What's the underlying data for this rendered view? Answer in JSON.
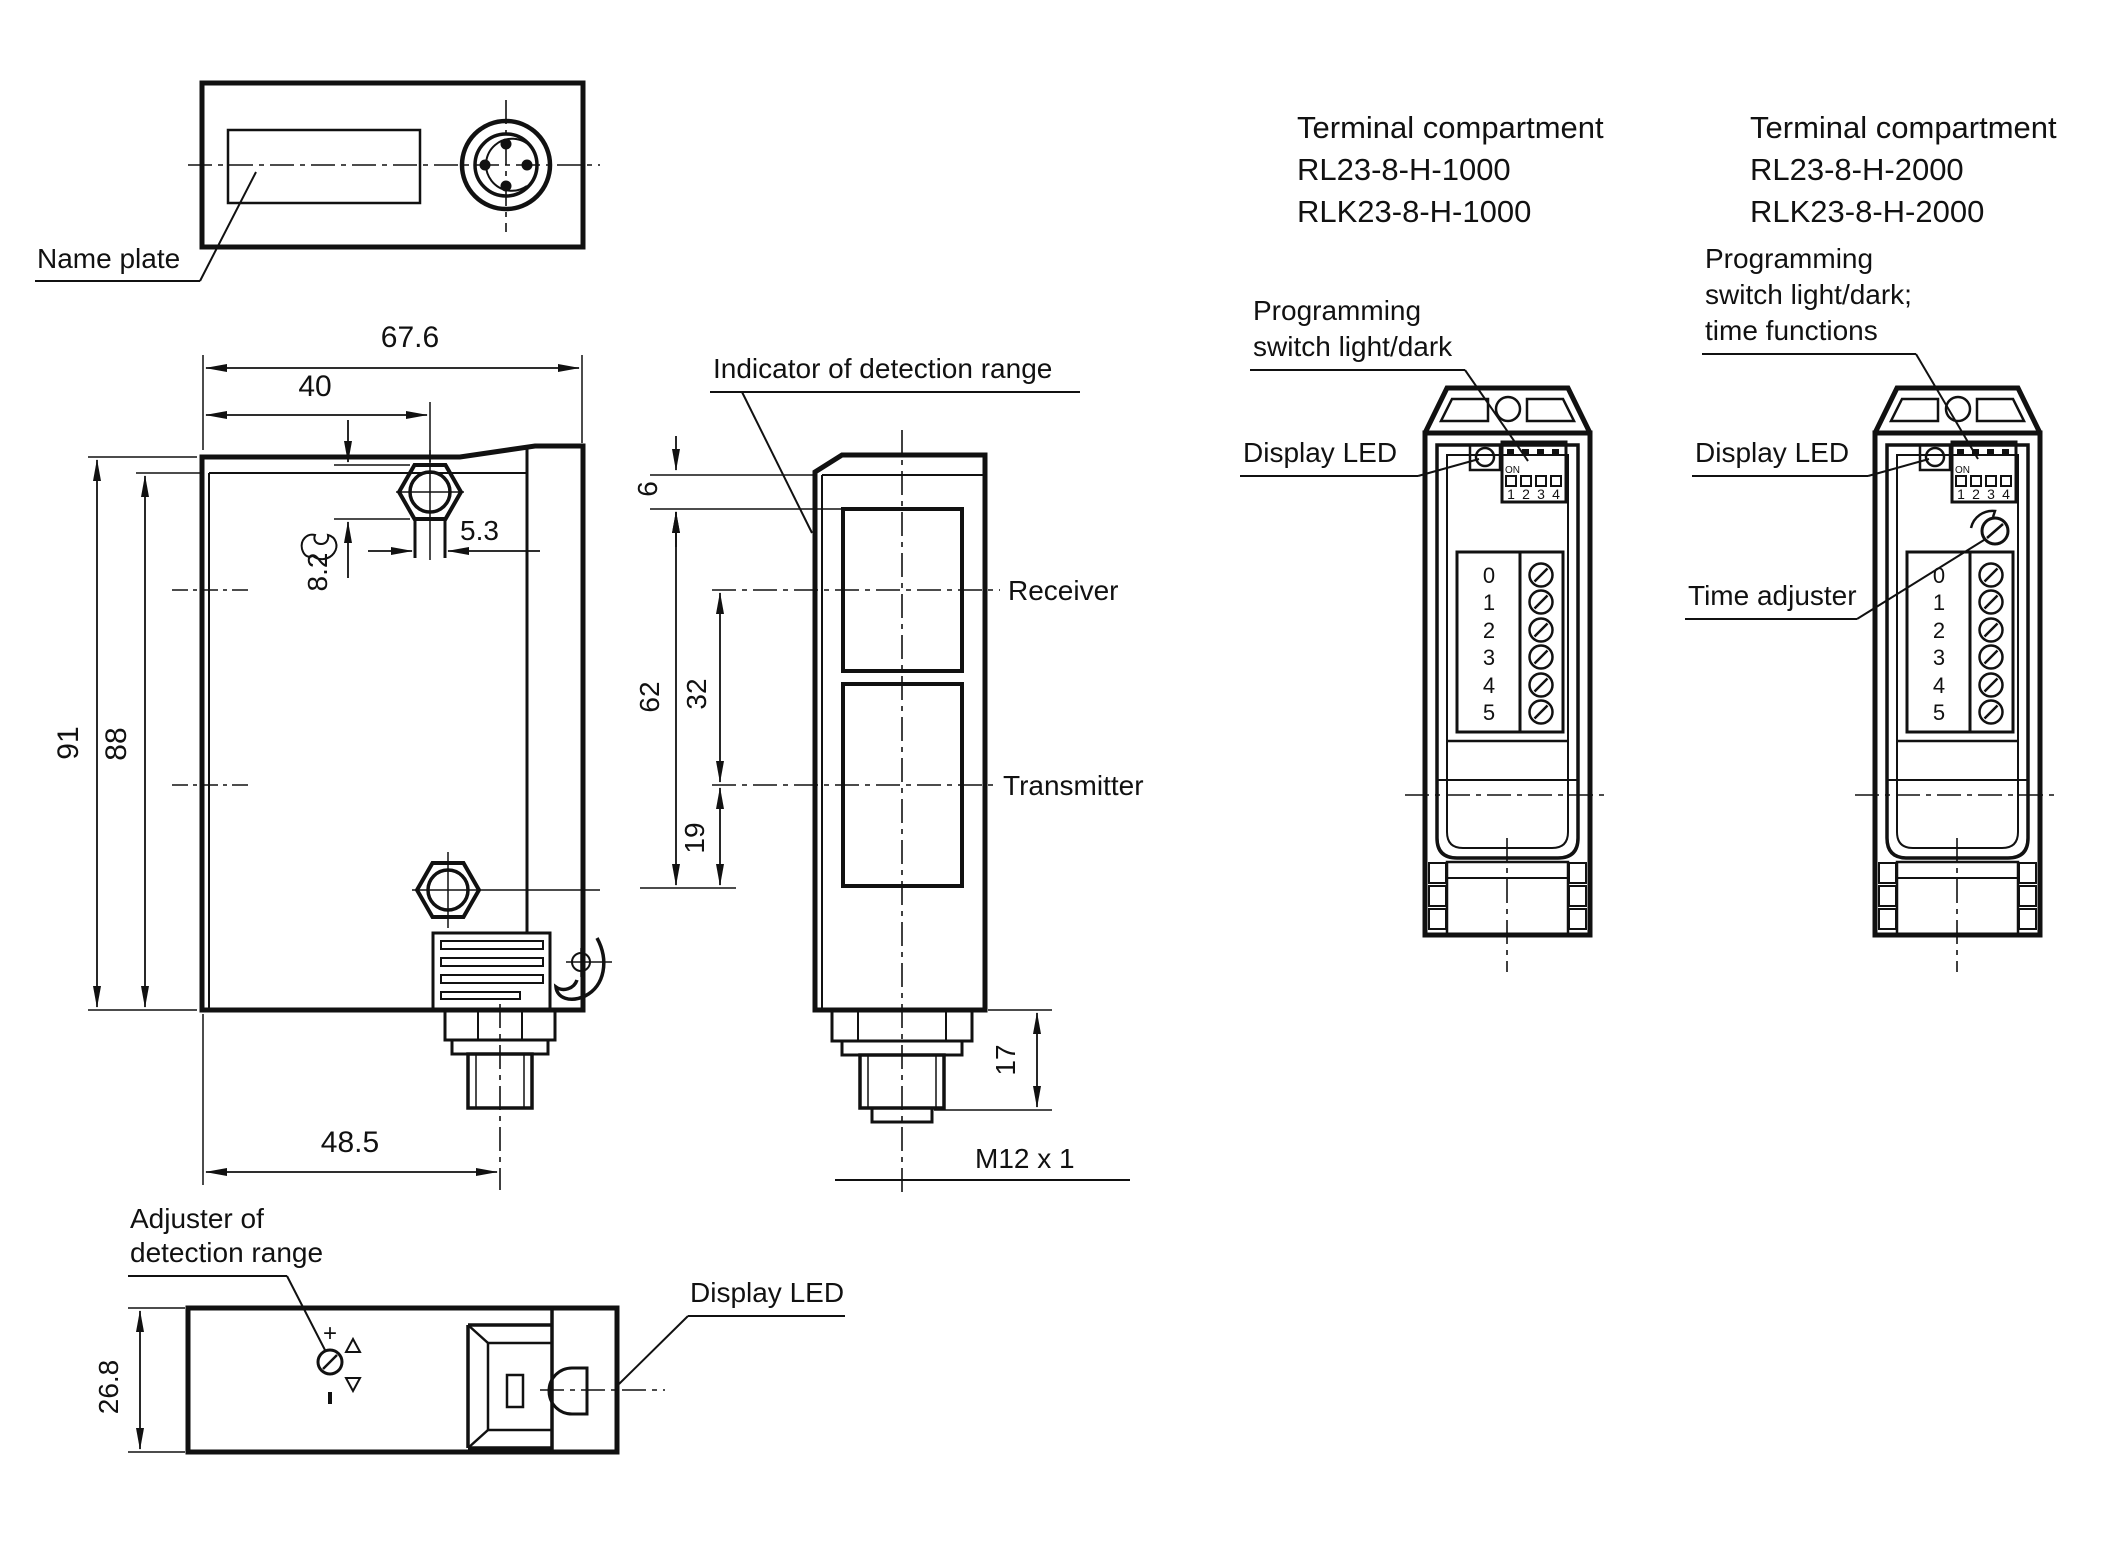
{
  "page": {
    "background": "#ffffff",
    "ink": "#111111"
  },
  "top_view": {
    "name_plate_label": "Name plate"
  },
  "front_view": {
    "dim_width": "67.6",
    "dim_hole_x": "40",
    "dim_height_outer": "91",
    "dim_height_inner": "88",
    "dim_nut_flats": "8.2",
    "dim_slot_width": "5.3",
    "dim_connector_x": "48.5"
  },
  "side_view": {
    "indicator_label": "Indicator of detection range",
    "receiver_label": "Receiver",
    "transmitter_label": "Transmitter",
    "dim_top_edge": "6",
    "dim_window": "62",
    "dim_axis_gap": "32",
    "dim_lower": "19",
    "dim_thread": "17",
    "thread_label": "M12 x 1"
  },
  "bottom_view": {
    "adjuster_label_line1": "Adjuster of",
    "adjuster_label_line2": "detection range",
    "display_led_label": "Display LED",
    "dim_depth": "26.8",
    "plus_mark": "+"
  },
  "terminal_shared": {
    "dip_on": "ON",
    "dip_digits": [
      "1",
      "2",
      "3",
      "4"
    ],
    "terminal_numbers": [
      "0",
      "1",
      "2",
      "3",
      "4",
      "5"
    ]
  },
  "terminal_1": {
    "title": "Terminal compartment",
    "model_a": "RL23-8-H-1000",
    "model_b": "RLK23-8-H-1000",
    "programming_line1": "Programming",
    "programming_line2": "switch light/dark",
    "display_led_label": "Display LED"
  },
  "terminal_2": {
    "title": "Terminal compartment",
    "model_a": "RL23-8-H-2000",
    "model_b": "RLK23-8-H-2000",
    "programming_line1": "Programming",
    "programming_line2": "switch light/dark;",
    "programming_line3": "time functions",
    "display_led_label": "Display LED",
    "time_adjuster_label": "Time adjuster"
  }
}
